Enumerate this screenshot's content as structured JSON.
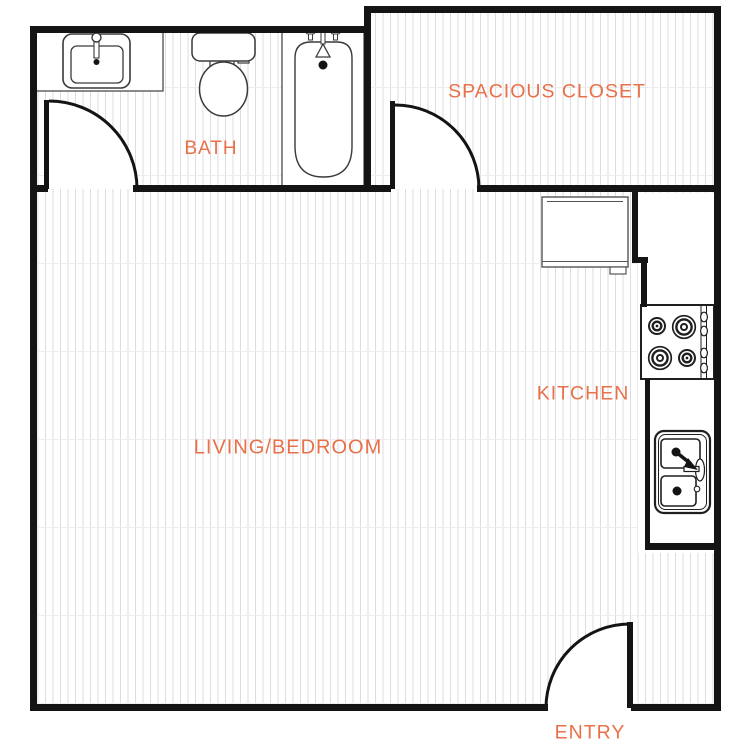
{
  "floor_plan": {
    "rooms": [
      {
        "name": "bath",
        "label": "BATH"
      },
      {
        "name": "spacious-closet",
        "label": "SPACIOUS CLOSET"
      },
      {
        "name": "living-bedroom",
        "label": "LIVING/BEDROOM"
      },
      {
        "name": "kitchen",
        "label": "KITCHEN"
      },
      {
        "name": "entry",
        "label": "ENTRY"
      }
    ],
    "fixtures": [
      {
        "icon": "bathroom-sink-icon",
        "room": "BATH"
      },
      {
        "icon": "toilet-icon",
        "room": "BATH"
      },
      {
        "icon": "bathtub-icon",
        "room": "BATH"
      },
      {
        "icon": "door-swing-icon",
        "room": "BATH"
      },
      {
        "icon": "door-swing-icon",
        "room": "SPACIOUS CLOSET"
      },
      {
        "icon": "refrigerator-icon",
        "room": "KITCHEN"
      },
      {
        "icon": "stove-icon",
        "room": "KITCHEN"
      },
      {
        "icon": "kitchen-sink-icon",
        "room": "KITCHEN"
      },
      {
        "icon": "door-swing-icon",
        "room": "ENTRY"
      }
    ],
    "colors": {
      "label": "#E8714A",
      "wall": "#141414",
      "floor_hatch": "#DCDCE1",
      "fixture_line": "#3A3A3A",
      "background": "#FFFFFF"
    }
  }
}
